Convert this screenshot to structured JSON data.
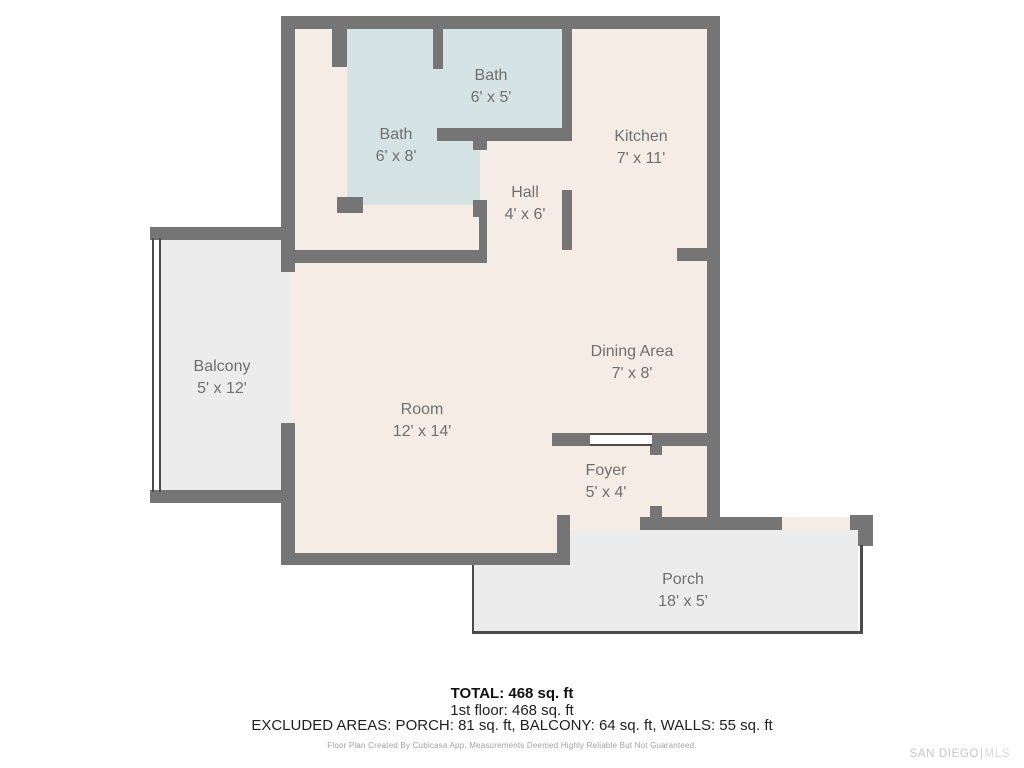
{
  "plan": {
    "rooms": [
      {
        "name": "Bath",
        "dims": "6' x 5'"
      },
      {
        "name": "Bath",
        "dims": "6' x 8'"
      },
      {
        "name": "Kitchen",
        "dims": "7' x 11'"
      },
      {
        "name": "Hall",
        "dims": "4' x 6'"
      },
      {
        "name": "Balcony",
        "dims": "5' x 12'"
      },
      {
        "name": "Dining Area",
        "dims": "7' x 8'"
      },
      {
        "name": "Room",
        "dims": "12' x 14'"
      },
      {
        "name": "Foyer",
        "dims": "5' x 4'"
      },
      {
        "name": "Porch",
        "dims": "18' x 5'"
      }
    ],
    "colors": {
      "wall": "#757575",
      "floor": "#f5ece5",
      "wet_room": "#d6e3e4",
      "outdoor": "#ececec",
      "label_text": "#6f6f6f"
    }
  },
  "summary": {
    "total": "TOTAL: 468 sq. ft",
    "floor": "1st floor: 468 sq. ft",
    "excluded": "EXCLUDED AREAS: PORCH: 81 sq. ft, BALCONY: 64 sq. ft, WALLS: 55 sq. ft",
    "disclaimer": "Floor Plan Created By Cubicasa App. Measurements Deemed Highly Reliable But Not Guaranteed."
  },
  "watermark": {
    "agency": "SAN DIEGO",
    "separator": "|",
    "suffix": "MLS"
  }
}
